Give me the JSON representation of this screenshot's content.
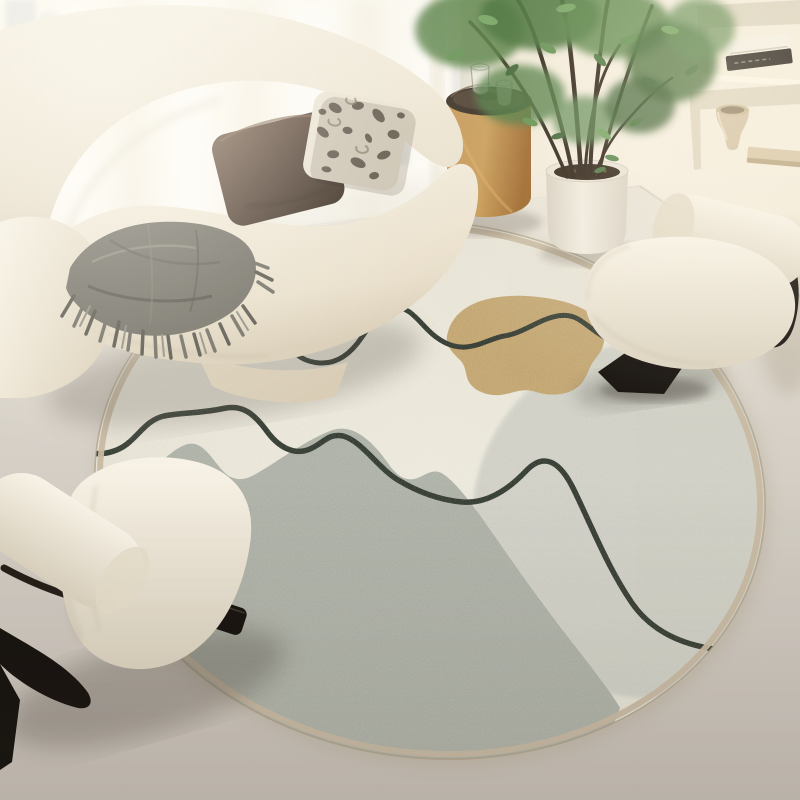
{
  "scene": {
    "title": "Minimalist living room corner with a round abstract area rug",
    "setting": "daylit room, sheer-curtained window at left, cream niche wall at right",
    "objects": [
      {
        "name": "curved-sofa",
        "description": "cream boucle curved sofa"
      },
      {
        "name": "throw-blanket",
        "description": "grey fringed throw draped over the seat"
      },
      {
        "name": "pillow-chocolate",
        "description": "dark chocolate brown cushion"
      },
      {
        "name": "pillow-leopard",
        "description": "cream and taupe animal print cushion"
      },
      {
        "name": "round-rug",
        "description": "round cream rug with grey blob, light grey circle, tan blob and black line doodles"
      },
      {
        "name": "accent-chair-right",
        "description": "white boucle slipper chair on curved black wood base"
      },
      {
        "name": "accent-chair-left",
        "description": "white boucle slipper chair on curved black wood base"
      },
      {
        "name": "side-table",
        "description": "caramel drum side table with dark round tray"
      },
      {
        "name": "glasses",
        "description": "two drinking glasses on the tray"
      },
      {
        "name": "potted-tree",
        "description": "indoor tree with dark stems in a white ceramic pot"
      },
      {
        "name": "wall-niches",
        "description": "two recessed wall shelves holding books and a beige vase"
      },
      {
        "name": "window",
        "description": "bright window with sheer curtains and faint building silhouettes"
      }
    ],
    "palette": {
      "wall_cream": "#f2ebdd",
      "window_light": "#fdfcf7",
      "floor": "#d4cec6",
      "sofa_cream": "#eee7d7",
      "pillow_brown": "#4a372a",
      "throw_grey": "#6f6c62",
      "wood_caramel": "#b9803f",
      "tray_brown": "#2e241a",
      "pot_white": "#ede8dd",
      "leaf_green": "#47703a",
      "chair_black": "#17120d",
      "rug_cream": "#e9e5d8",
      "rug_grey_circle": "#cdcdc3",
      "rug_grey_blob": "#a9ada2",
      "rug_tan": "#c0a066",
      "rug_line": "#232b21",
      "rug_binding": "#c8b9a2"
    }
  }
}
